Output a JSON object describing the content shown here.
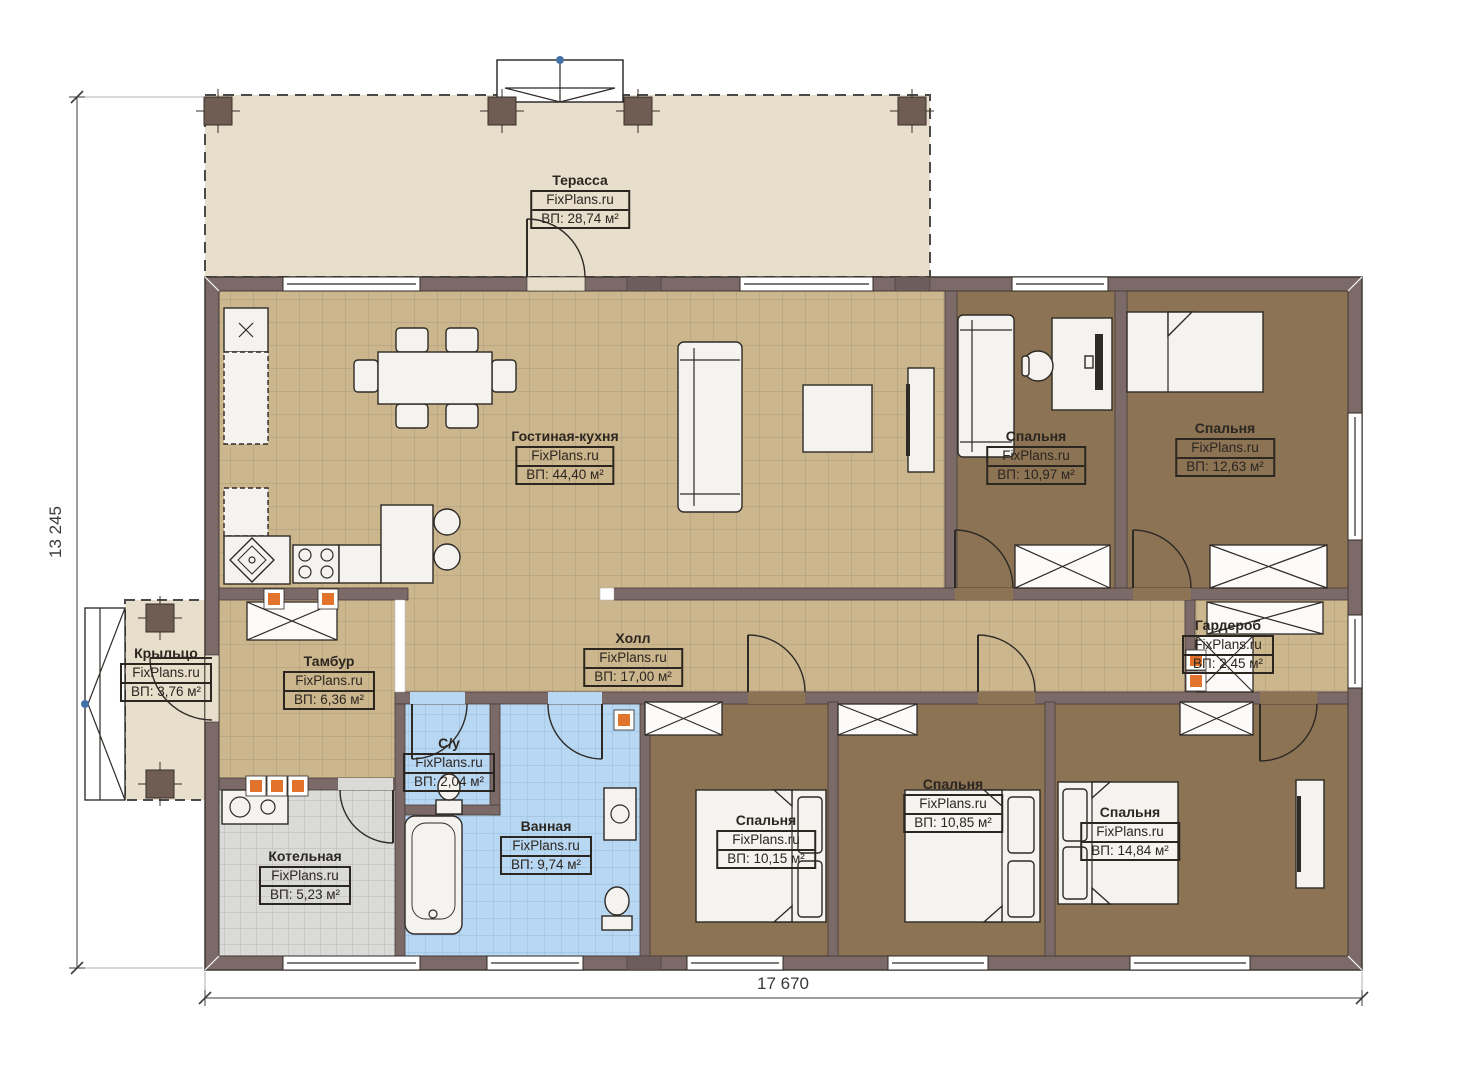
{
  "plan": {
    "watermark": "FixPlans.ru",
    "dimensions": {
      "width_label": "17 670",
      "height_label": "13 245"
    },
    "rooms": [
      {
        "id": "terrace",
        "name": "Терасса",
        "area": "ВП: 28,74 м²"
      },
      {
        "id": "living-kitchen",
        "name": "Гостиная-кухня",
        "area": "ВП: 44,40 м²"
      },
      {
        "id": "bedroom-top-1",
        "name": "Спальня",
        "area": "ВП: 10,97 м²"
      },
      {
        "id": "bedroom-top-2",
        "name": "Спальня",
        "area": "ВП: 12,63 м²"
      },
      {
        "id": "porch",
        "name": "Крыльцо",
        "area": "ВП: 3,76 м²"
      },
      {
        "id": "vestibule",
        "name": "Тамбур",
        "area": "ВП: 6,36 м²"
      },
      {
        "id": "hall",
        "name": "Холл",
        "area": "ВП: 17,00 м²"
      },
      {
        "id": "wardrobe-room",
        "name": "Гардероб",
        "area": "ВП: 2,45 м²"
      },
      {
        "id": "wc",
        "name": "С/у",
        "area": "ВП: 2,04 м²"
      },
      {
        "id": "bathroom",
        "name": "Ванная",
        "area": "ВП: 9,74 м²"
      },
      {
        "id": "boiler-room",
        "name": "Котельная",
        "area": "ВП: 5,23 м²"
      },
      {
        "id": "bedroom-bot-1",
        "name": "Спальня",
        "area": "ВП: 10,15 м²"
      },
      {
        "id": "bedroom-bot-2",
        "name": "Спальня",
        "area": "ВП: 10,85 м²"
      },
      {
        "id": "bedroom-bot-3",
        "name": "Спальня",
        "area": "ВП: 14,84 м²"
      }
    ],
    "colors": {
      "wall": "#7b6a67",
      "tile_floor": "#ccb68d",
      "bedroom_floor": "#8b7354",
      "bathroom_floor": "#b8d7f2",
      "boiler_floor": "#dadad8",
      "terrace_floor": "#e7decb",
      "accent_orange": "#e2732d"
    }
  }
}
